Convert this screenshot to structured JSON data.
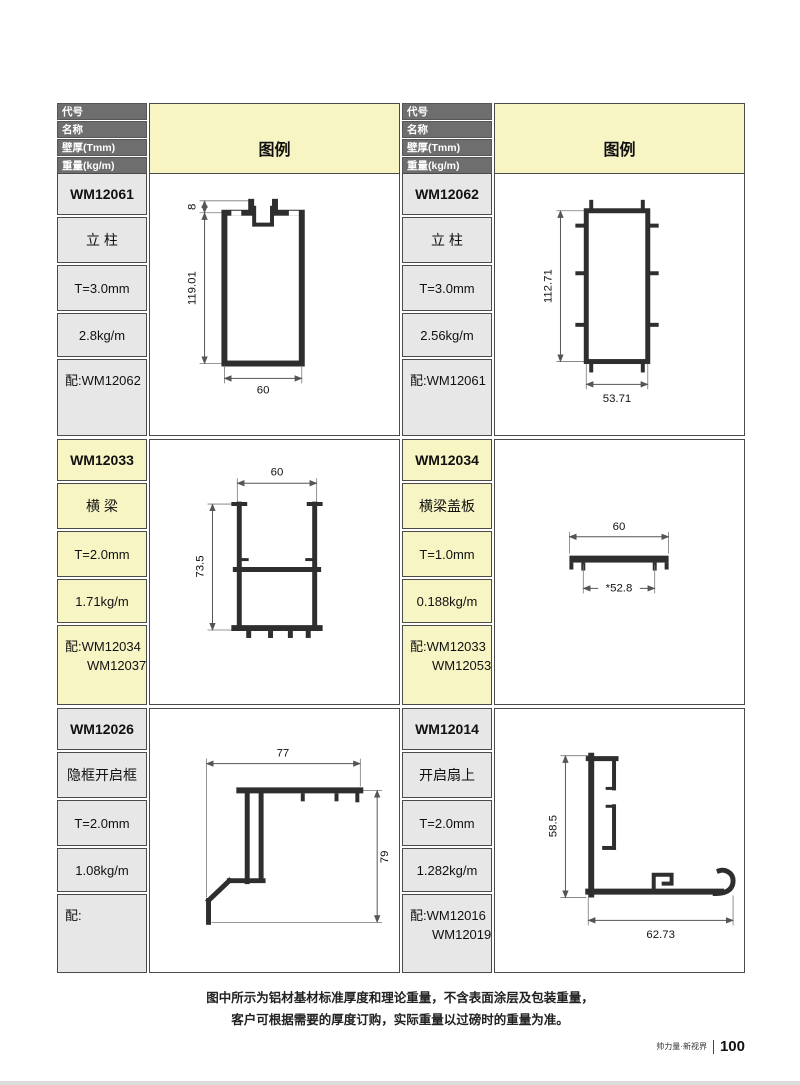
{
  "header": {
    "rows": [
      "代号",
      "名称",
      "壁厚(Tmm)",
      "重量(kg/m)",
      "配套"
    ],
    "legend": "图例"
  },
  "tables": [
    {
      "blocks": [
        {
          "code": "WM12061",
          "name": "立 柱",
          "thickness": "T=3.0mm",
          "weight": "2.8kg/m",
          "match1": "配:WM12062",
          "match2": "",
          "drawing": {
            "t": "8",
            "h": "119.01",
            "w": "60"
          }
        },
        {
          "code": "WM12033",
          "name": "横 梁",
          "thickness": "T=2.0mm",
          "weight": "1.71kg/m",
          "match1": "配:WM12034",
          "match2": "WM12037",
          "drawing": {
            "w": "60",
            "h": "73.5"
          }
        },
        {
          "code": "WM12026",
          "name": "隐框开启框",
          "thickness": "T=2.0mm",
          "weight": "1.08kg/m",
          "match1": "配:",
          "match2": "",
          "drawing": {
            "w": "77",
            "h": "79"
          }
        }
      ]
    },
    {
      "blocks": [
        {
          "code": "WM12062",
          "name": "立 柱",
          "thickness": "T=3.0mm",
          "weight": "2.56kg/m",
          "match1": "配:WM12061",
          "match2": "",
          "drawing": {
            "h": "112.71",
            "w": "53.71"
          }
        },
        {
          "code": "WM12034",
          "name": "横梁盖板",
          "thickness": "T=1.0mm",
          "weight": "0.188kg/m",
          "match1": "配:WM12033",
          "match2": "WM12053",
          "drawing": {
            "w": "60",
            "w2": "*52.8"
          }
        },
        {
          "code": "WM12014",
          "name": "开启扇上",
          "thickness": "T=2.0mm",
          "weight": "1.282kg/m",
          "match1": "配:WM12016",
          "match2": "WM12019",
          "drawing": {
            "h": "58.5",
            "w": "62.73"
          }
        }
      ]
    }
  ],
  "footer": {
    "note_line1": "图中所示为铝材基材标准厚度和理论重量，不含表面涂层及包装重量，",
    "note_line2": "客户可根据需要的厚度订购，实际重量以过磅时的重量为准。",
    "brand": "帅力量·新视界",
    "page_number": "100"
  },
  "colors": {
    "header_bg": "#6e6e6e",
    "legend_bg": "#f7f5c3",
    "cell_gray": "#e7e7e7",
    "cell_yellow": "#f7f5c3",
    "border": "#4a4a4a"
  }
}
